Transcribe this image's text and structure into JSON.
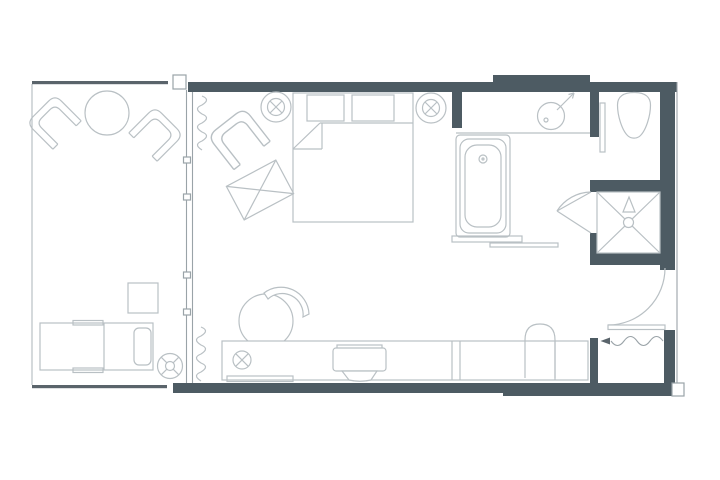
{
  "drawing": {
    "type": "floor-plan",
    "title": "",
    "colors": {
      "background": "#ffffff",
      "wall": "#4d5b63",
      "rail": "#5a646b",
      "furniture_line": "#b9c0c4",
      "medium_line": "#9aa3a8"
    },
    "areas": {
      "balcony": {
        "fixtures": [
          "armchair-left",
          "armchair-right",
          "round-table",
          "side-table",
          "chaise-lounge",
          "ceiling-fan-symbol",
          "railing"
        ]
      },
      "bedroom": {
        "fixtures": [
          "double-bed",
          "pillow-left",
          "pillow-right",
          "duvet-fold",
          "armchair",
          "ottoman",
          "desk-chair",
          "media-console",
          "tv-unit",
          "floor-outlet-symbol",
          "tray",
          "ceiling-light-left",
          "ceiling-light-right",
          "curtain-top",
          "curtain-bottom",
          "sliding-glass-door"
        ]
      },
      "bathroom": {
        "fixtures": [
          "bathtub",
          "tub-drain",
          "tub-step",
          "towel-rail",
          "vanity-counter",
          "round-sink",
          "faucet",
          "toilet",
          "wc-door-leaf",
          "shower-pan",
          "shower-drain",
          "shower-head-symbol",
          "shower-door"
        ]
      },
      "entry": {
        "fixtures": [
          "entry-door",
          "door-swing-arc",
          "entrance-direction-arrow",
          "entrance-wavy-line",
          "closet-chair",
          "console-counter"
        ]
      }
    }
  }
}
